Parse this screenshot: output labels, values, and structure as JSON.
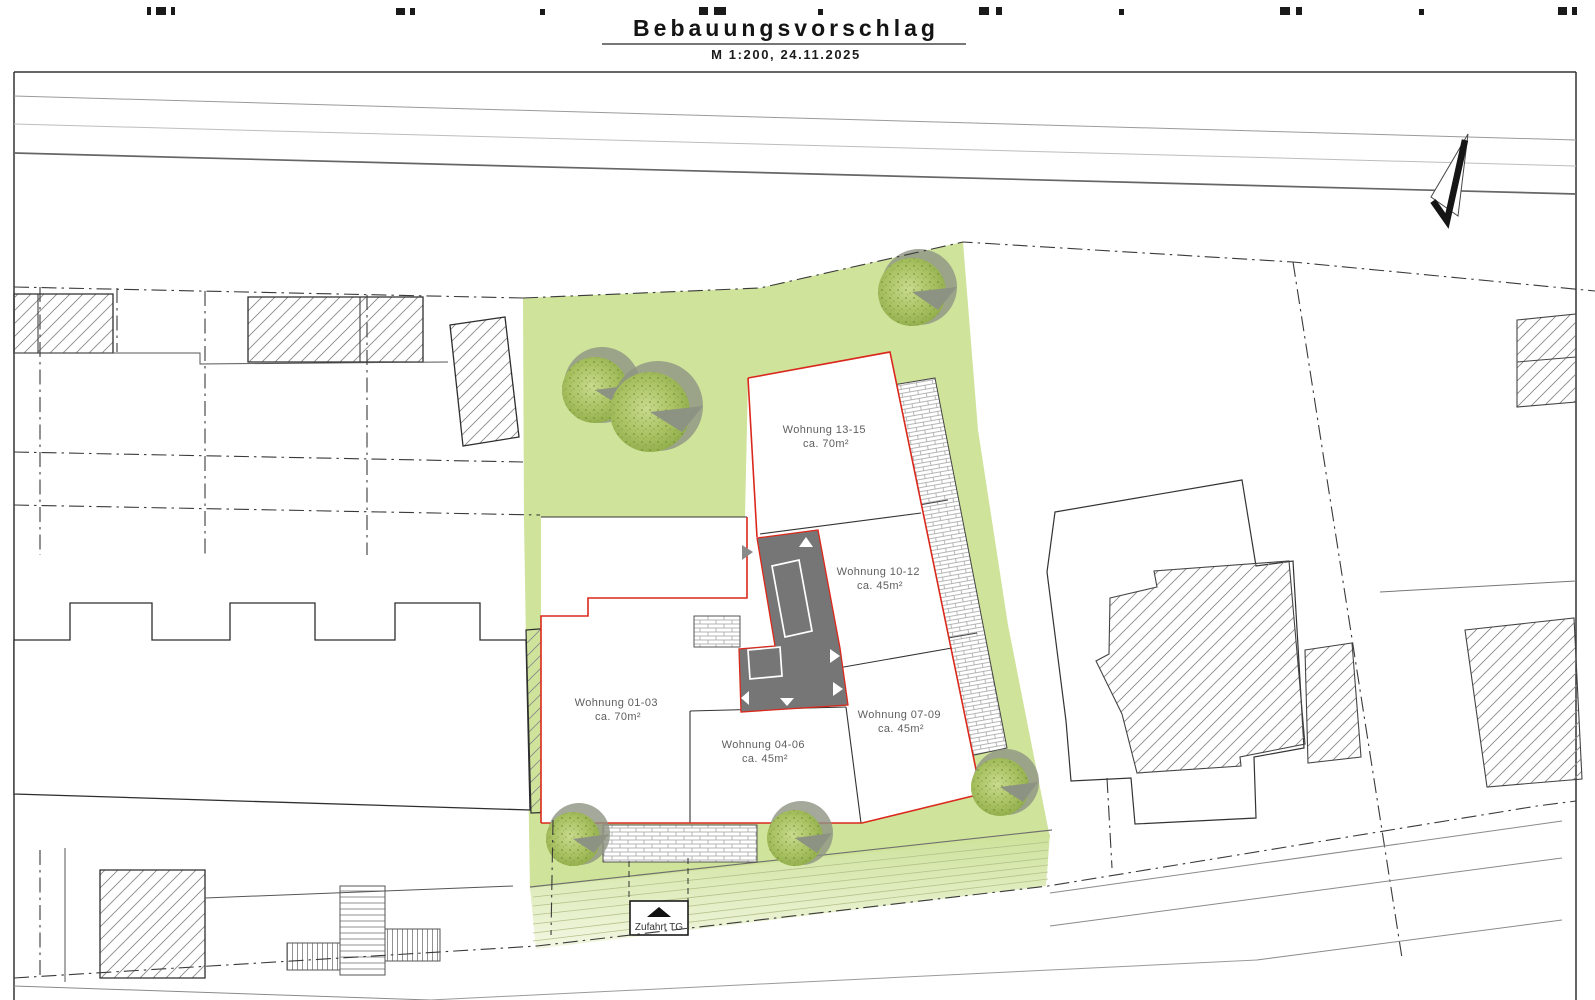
{
  "title": {
    "heading": "Bebauungsvorschlag",
    "scale_date": "M 1:200, 24.11.2025"
  },
  "units": [
    {
      "name": "Wohnung 13-15",
      "area": "ca. 70m²"
    },
    {
      "name": "Wohnung 10-12",
      "area": "ca. 45m²"
    },
    {
      "name": "Wohnung 01-03",
      "area": "ca. 70m²"
    },
    {
      "name": "Wohnung 04-06",
      "area": "ca. 45m²"
    },
    {
      "name": "Wohnung 07-09",
      "area": "ca. 45m²"
    }
  ],
  "annotations": {
    "garage_ramp": "Zufahrt TG"
  },
  "colors": {
    "site_green": "#cfe39b",
    "ramp_light": "#eef4da",
    "outline_red": "#da291c",
    "stair_gray": "#767676",
    "tree_green": "#a4bd5e",
    "tree_shadow": "#8d9383",
    "line_dark": "#3a3a3a",
    "label_gray": "#5f5f5f"
  }
}
